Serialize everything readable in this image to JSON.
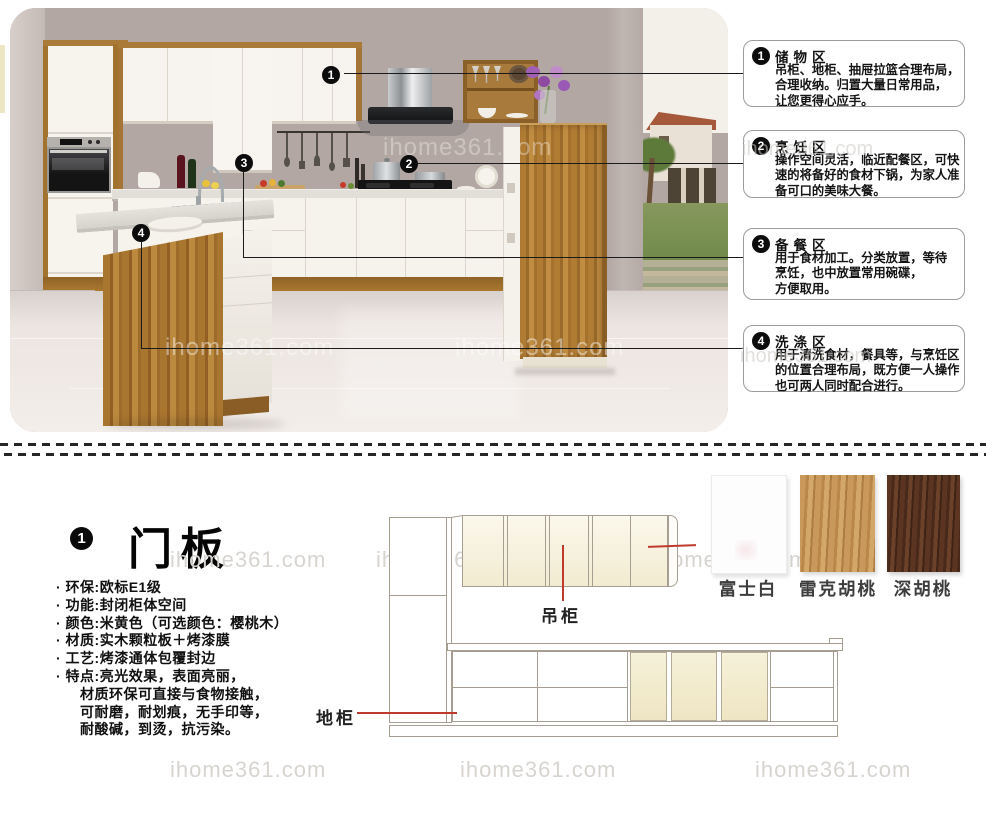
{
  "watermark": "ihome361.com",
  "markers": [
    "1",
    "2",
    "3",
    "4"
  ],
  "callouts": [
    {
      "num": "1",
      "title": "储物区",
      "lines": [
        "吊柜、地柜、抽屉拉篮合理布局，",
        "合理收纳。归置大量日常用品，",
        "让您更得心应手。"
      ]
    },
    {
      "num": "2",
      "title": "烹饪区",
      "lines": [
        "操作空间灵活，临近配餐区，可快",
        "速的将备好的食材下锅，为家人准",
        "备可口的美味大餐。"
      ]
    },
    {
      "num": "3",
      "title": "备餐区",
      "lines": [
        "用于食材加工。分类放置，等待",
        "烹饪，也中放置常用碗碟，",
        "方便取用。"
      ]
    },
    {
      "num": "4",
      "title": "洗涤区",
      "lines": [
        "用于清洗食材，餐具等，与烹饪区",
        "的位置合理布局，既方便一人操作",
        "也可两人同时配合进行。"
      ]
    }
  ],
  "section": {
    "num": "1",
    "title": "门板"
  },
  "specs": [
    "· 环保:欧标E1级",
    "· 功能:封闭柜体空间",
    "· 颜色:米黄色（可选颜色：樱桃木）",
    "· 材质:实木颗粒板＋烤漆膜",
    "· 工艺:烤漆通体包覆封边",
    "· 特点:亮光效果，表面亮丽，",
    "材质环保可直接与食物接触，",
    "可耐磨，耐划痕，无手印等，",
    "耐酸碱，到烫，抗污染。"
  ],
  "diagram": {
    "hanging_label": "吊柜",
    "base_label": "地柜"
  },
  "swatches": [
    {
      "name": "富士白",
      "color": "#fdfdfd"
    },
    {
      "name": "雷克胡桃",
      "color": "#c49459"
    },
    {
      "name": "深胡桃",
      "color": "#54311e"
    }
  ],
  "colors": {
    "red_line": "#bf3a2c",
    "callout_border": "#9c9c9c",
    "wood": "#a97a38",
    "cream_door": "#f4eed6",
    "wall": "#b2a7a2"
  }
}
